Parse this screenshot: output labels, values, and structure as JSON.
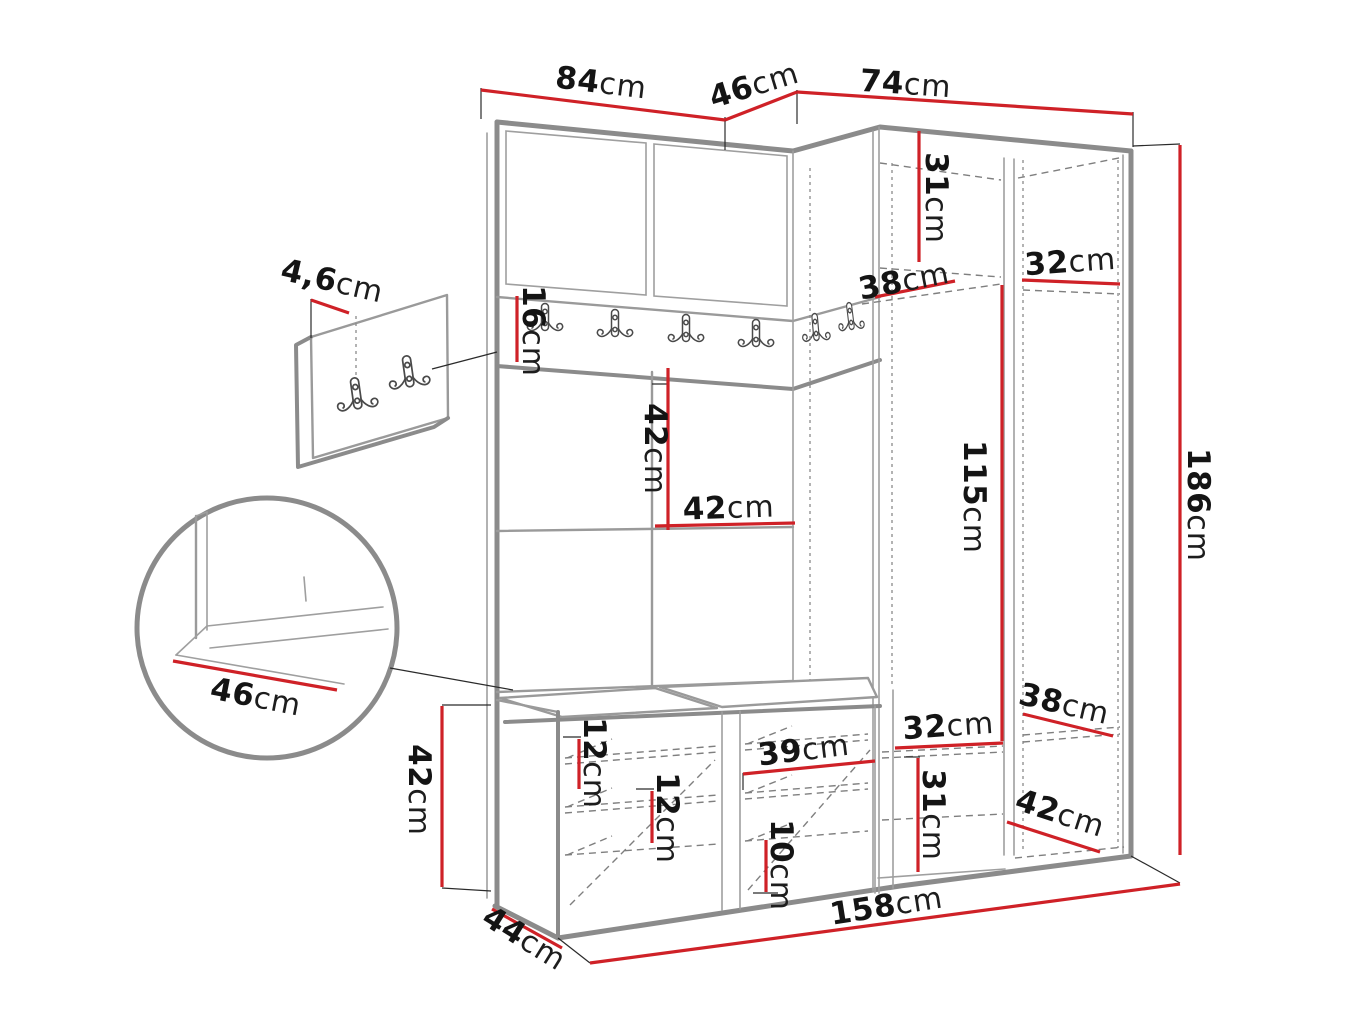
{
  "diagram": {
    "type": "furniture-dimension-drawing",
    "subject": "hallway wardrobe corner set with coat hooks and shoe bench",
    "unit_suffix": "cm",
    "colors": {
      "dimension_line": "#cf2127",
      "outline_gray": "#8b8b8b",
      "label_text": "#141414",
      "background": "#ffffff"
    }
  },
  "dims": {
    "left_section_width": {
      "value": "84",
      "unit": "cm"
    },
    "corner_section_width": {
      "value": "46",
      "unit": "cm"
    },
    "right_section_width": {
      "value": "74",
      "unit": "cm"
    },
    "total_height": {
      "value": "186",
      "unit": "cm"
    },
    "wall_panel_thickness": {
      "value": "4,6",
      "unit": "cm"
    },
    "hook_rail_height": {
      "value": "16",
      "unit": "cm"
    },
    "top_shelf_height": {
      "value": "31",
      "unit": "cm"
    },
    "top_shelf_depth": {
      "value": "38",
      "unit": "cm"
    },
    "top_side_shelf_width": {
      "value": "32",
      "unit": "cm"
    },
    "wall_panel_height": {
      "value": "42",
      "unit": "cm"
    },
    "wall_panel_width": {
      "value": "42",
      "unit": "cm"
    },
    "hanging_space_height": {
      "value": "115",
      "unit": "cm"
    },
    "seat_depth_detail": {
      "value": "46",
      "unit": "cm"
    },
    "bench_height": {
      "value": "42",
      "unit": "cm"
    },
    "shoe_shelf_spacing_top": {
      "value": "12",
      "unit": "cm"
    },
    "shoe_shelf_spacing_mid": {
      "value": "12",
      "unit": "cm"
    },
    "bench_compartment_width": {
      "value": "39",
      "unit": "cm"
    },
    "bench_bottom_spacing": {
      "value": "10",
      "unit": "cm"
    },
    "lower_side_shelf_width": {
      "value": "32",
      "unit": "cm"
    },
    "lower_side_shelf_height": {
      "value": "31",
      "unit": "cm"
    },
    "lower_shelf_depth": {
      "value": "38",
      "unit": "cm"
    },
    "lower_right_shelf_depth": {
      "value": "42",
      "unit": "cm"
    },
    "total_width": {
      "value": "158",
      "unit": "cm"
    },
    "bench_depth": {
      "value": "44",
      "unit": "cm"
    }
  }
}
